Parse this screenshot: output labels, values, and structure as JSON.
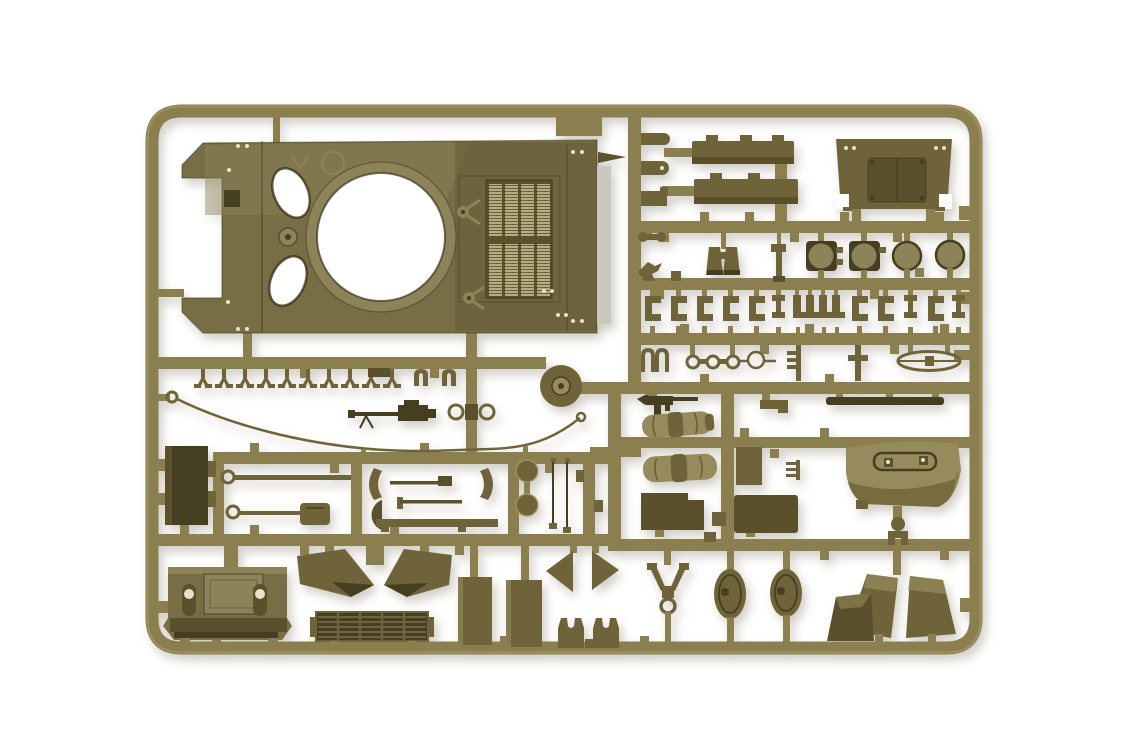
{
  "image": {
    "subject": "injection-molded plastic model kit sprue with olive-drab tank parts photographed on a white background",
    "background_color": "#ffffff"
  },
  "palette": {
    "background": "#ffffff",
    "runner": "#8b7e4f",
    "runner_hi": "#ab9f73",
    "part": "#6f6439",
    "part_dark": "#5a502c",
    "part_darkest": "#463e20",
    "part_light": "#968b5c",
    "hull": "#786e45",
    "hull_light": "#8c8358",
    "edge_dark": "#3c351c",
    "grille_light": "#b5ac83",
    "gray_strip": "#c9c8c3",
    "rivet": "#e8e3c8"
  },
  "parts": {
    "labels": [
      "sprue-frame",
      "upper-hull-with-turret-ring",
      "engine-deck-grille",
      "hatch-openings",
      "stowage-bar-1",
      "stowage-bar-2",
      "transmission-cover-plate",
      "round-hatch-1",
      "round-hatch-2",
      "round-hatch-3",
      "round-hatch-4",
      "binoculars",
      "periscope",
      "small-clamp-set",
      "tow-shackle-row",
      "tow-cable",
      "machine-gun",
      "submachine-gun",
      "ring-links",
      "trident-tool",
      "blade-part",
      "rolled-tarp-1",
      "rolled-tarp-2",
      "idler-wheel",
      "tool-box",
      "rod-with-eyelet-1",
      "rod-with-eyelet-2",
      "crescent-brace-1",
      "crescent-brace-2",
      "wheel-disc-1",
      "wheel-disc-2",
      "antenna-rods",
      "rear-hull-plate",
      "headlights",
      "fender-plate-1",
      "fender-plate-2",
      "intake-grille",
      "side-plate-1",
      "side-plate-2",
      "pennant-arrow-left",
      "pennant-arrow-right",
      "track-fork-1",
      "track-fork-2",
      "curved-shield-cover",
      "mudguard-left",
      "mudguard-right",
      "wedge-block",
      "wishbone-linkage",
      "oval-hatch-1",
      "oval-hatch-2",
      "dark-panel-1",
      "dark-panel-2"
    ]
  }
}
